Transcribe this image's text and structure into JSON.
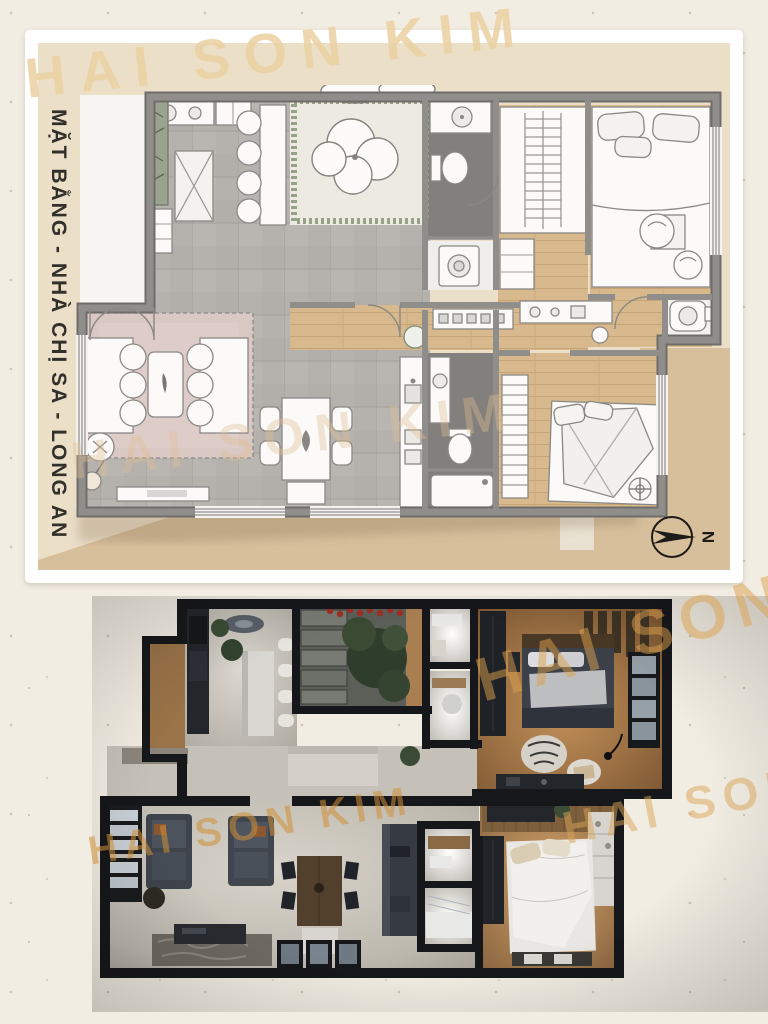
{
  "document": {
    "vertical_title": "MẶT BẰNG - NHÀ CHỊ SA - LONG AN",
    "watermark_text": "HAI SON KIM",
    "compass_label": "N"
  },
  "colors": {
    "page_background": "#f2ede3",
    "panel_frame": "#ffffff",
    "panel_beige": "#ebdfc8",
    "panel_tan": "#d8bf9c",
    "watermark_tan": "#ecd2a4",
    "watermark_orange": "#d89b40",
    "plan_wall_gray": "#8f8d8a",
    "plan_tile_gray": "#b5b2ae",
    "plan_wood": "#d8b98d",
    "plan_rug_pink": "#d9c8c4",
    "plan_bath_floor": "#827f7c",
    "render_wall_black": "#16171a",
    "render_wood": "#a87f52",
    "render_floor_gray": "#c4bfb6",
    "render_furniture_dark": "#3f444c"
  }
}
